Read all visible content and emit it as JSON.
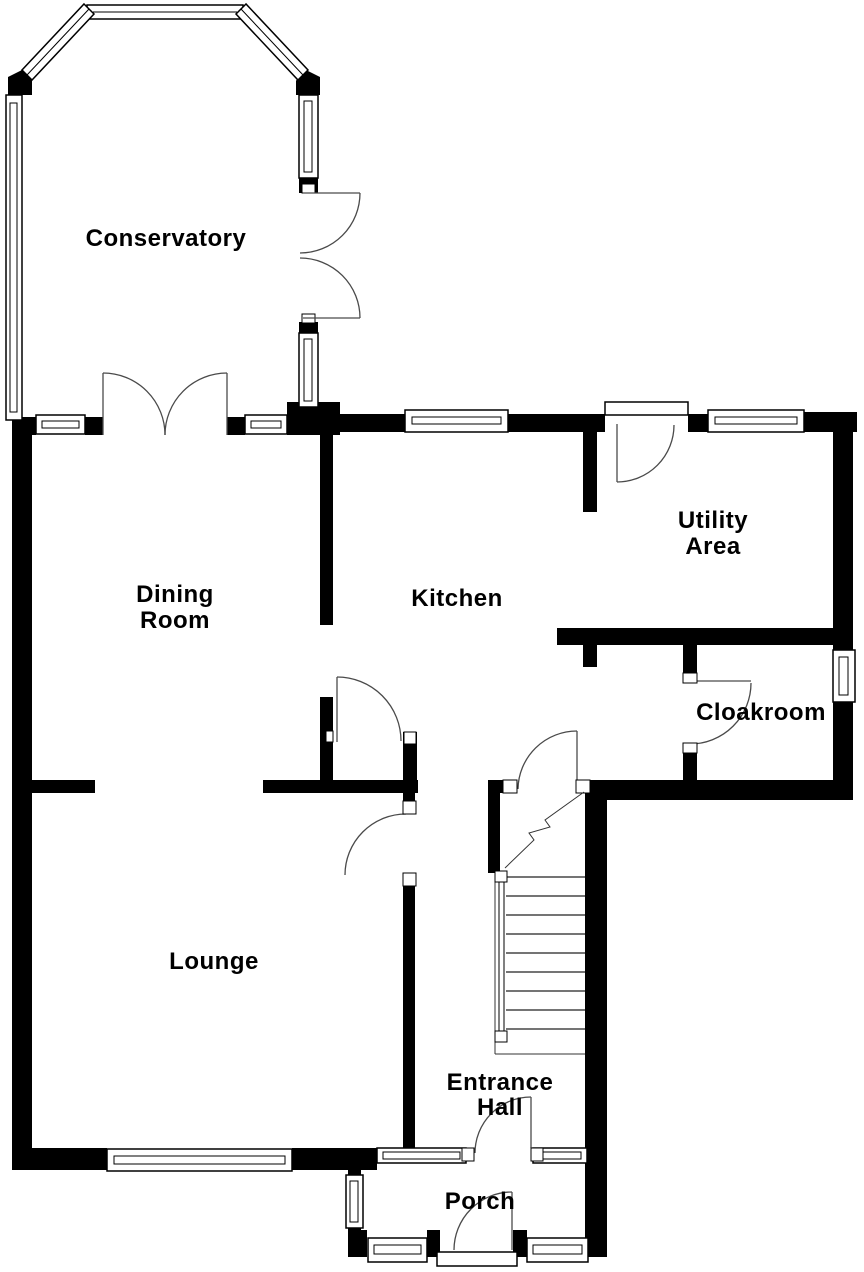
{
  "colors": {
    "wall": "#000000",
    "background": "#ffffff",
    "door_swing": "#4a4a4a",
    "text": "#000000"
  },
  "rooms": {
    "conservatory": {
      "lines": [
        "Conservatory"
      ]
    },
    "dining_room": {
      "lines": [
        "Dining",
        "Room"
      ]
    },
    "kitchen": {
      "lines": [
        "Kitchen"
      ]
    },
    "utility_area": {
      "lines": [
        "Utility",
        "Area"
      ]
    },
    "cloakroom": {
      "lines": [
        "Cloakroom"
      ]
    },
    "lounge": {
      "lines": [
        "Lounge"
      ]
    },
    "entrance_hall": {
      "lines": [
        "Entrance",
        "Hall"
      ]
    },
    "porch": {
      "lines": [
        "Porch"
      ]
    }
  }
}
